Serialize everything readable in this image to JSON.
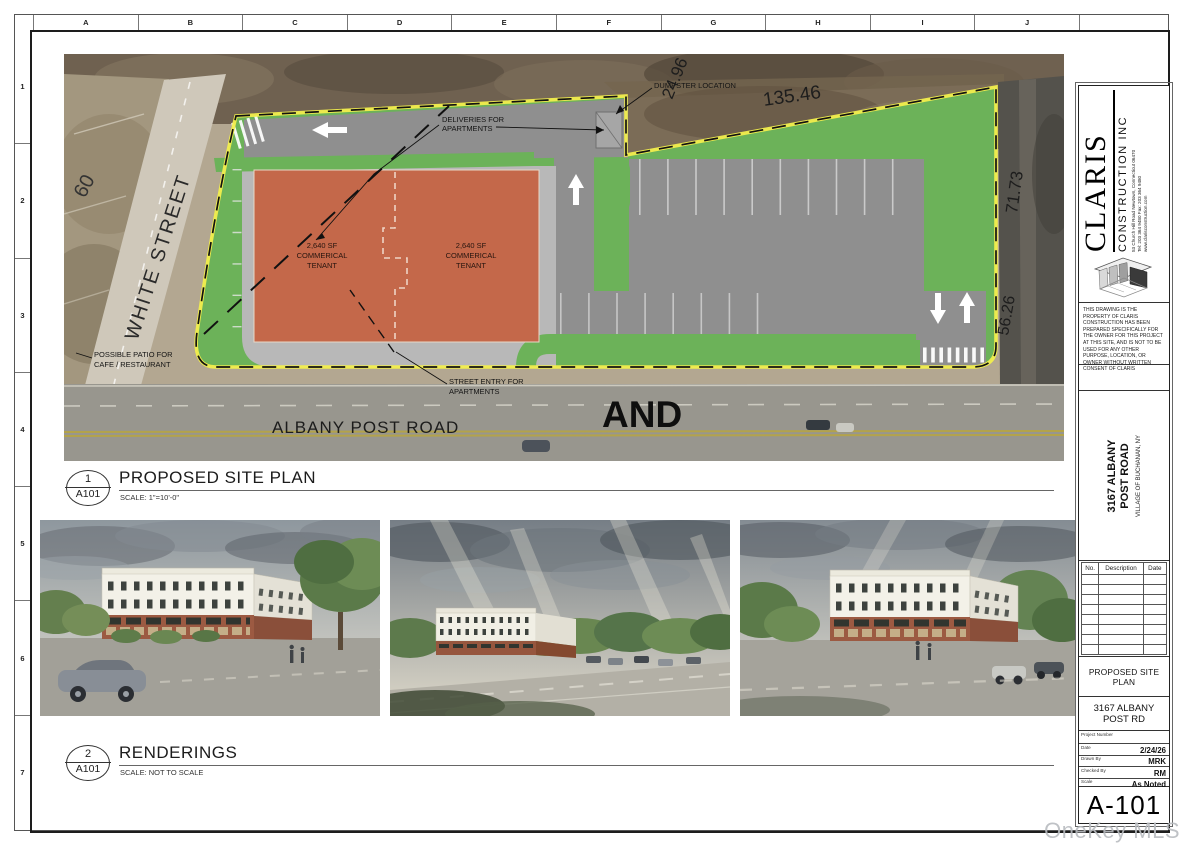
{
  "sheet": {
    "grid_letters": [
      "A",
      "B",
      "C",
      "D",
      "E",
      "F",
      "G",
      "H",
      "I",
      "J"
    ],
    "grid_numbers": [
      "1",
      "2",
      "3",
      "4",
      "5",
      "6",
      "7"
    ]
  },
  "site_plan": {
    "view_number": "1",
    "view_sheet": "A101",
    "view_title": "PROPOSED SITE PLAN",
    "view_scale": "SCALE: 1\"=10'-0\"",
    "labels": {
      "deliveries_line1": "DELIVERIES FOR",
      "deliveries_line2": "APARTMENTS",
      "dumpster": "DUMPSTER LOCATION",
      "tenant_line1": "2,640 SF",
      "tenant_line2": "COMMERICAL",
      "tenant_line3": "TENANT",
      "patio_line1": "POSSIBLE PATIO FOR",
      "patio_line2": "CAFE / RESTAURANT",
      "street_entry_line1": "STREET ENTRY FOR",
      "street_entry_line2": "APARTMENTS",
      "white_street": "WHITE STREET",
      "albany_post_road": "ALBANY POST ROAD",
      "and_text": "AND"
    },
    "dimensions": {
      "west": "60",
      "north_short": "24.96",
      "north_long": "135.46",
      "east_upper": "71.73",
      "east_lower": "56.26"
    },
    "colors": {
      "landscape_green": "#6cb259",
      "pavement_gray": "#8f8f8f",
      "sidewalk_gray": "#b8b8b8",
      "building_orange": "#c4684a",
      "boundary_yellow": "#f2ee4d"
    }
  },
  "renderings_view": {
    "view_number": "2",
    "view_sheet": "A101",
    "view_title": "RENDERINGS",
    "view_scale": "SCALE: NOT TO SCALE"
  },
  "title_block": {
    "company_name": "CLARIS",
    "company_subtitle": "CONSTRUCTION INC",
    "address_line1": "53 Church Hill Road   Newtown, Connecticut 06470",
    "address_line2": "Tel:  203 364 9480      Fax:  203 364 9480",
    "address_line3": "www.clarisconstruction.com",
    "disclaimer": "THIS DRAWING IS THE PROPERTY OF CLARIS CONSTRUCTION HAS BEEN PREPARED SPECIFICALLY FOR THE OWNER FOR THIS PROJECT AT THIS SITE, AND IS NOT TO BE USED FOR ANY OTHER PURPOSE, LOCATION, OR OWNER WITHOUT WRITTEN CONSENT OF CLARIS",
    "project_name_line1": "3167 ALBANY",
    "project_name_line2": "POST ROAD",
    "project_location": "VILLAGE OF BUCHANAN, NY",
    "rev_col_no": "No.",
    "rev_col_description": "Description",
    "rev_col_date": "Date",
    "sheet_title": "PROPOSED SITE PLAN",
    "project_line1": "3167 ALBANY",
    "project_line2": "POST RD",
    "field_project_number_label": "Project Number",
    "field_date_label": "Date",
    "field_date_value": "2/24/26",
    "field_drawn_label": "Drawn By",
    "field_drawn_value": "MRK",
    "field_checked_label": "Checked By",
    "field_checked_value": "RM",
    "field_scale_label": "Scale",
    "field_scale_value": "As Noted",
    "sheet_number": "A-101"
  },
  "watermark": "OneKey MLS"
}
